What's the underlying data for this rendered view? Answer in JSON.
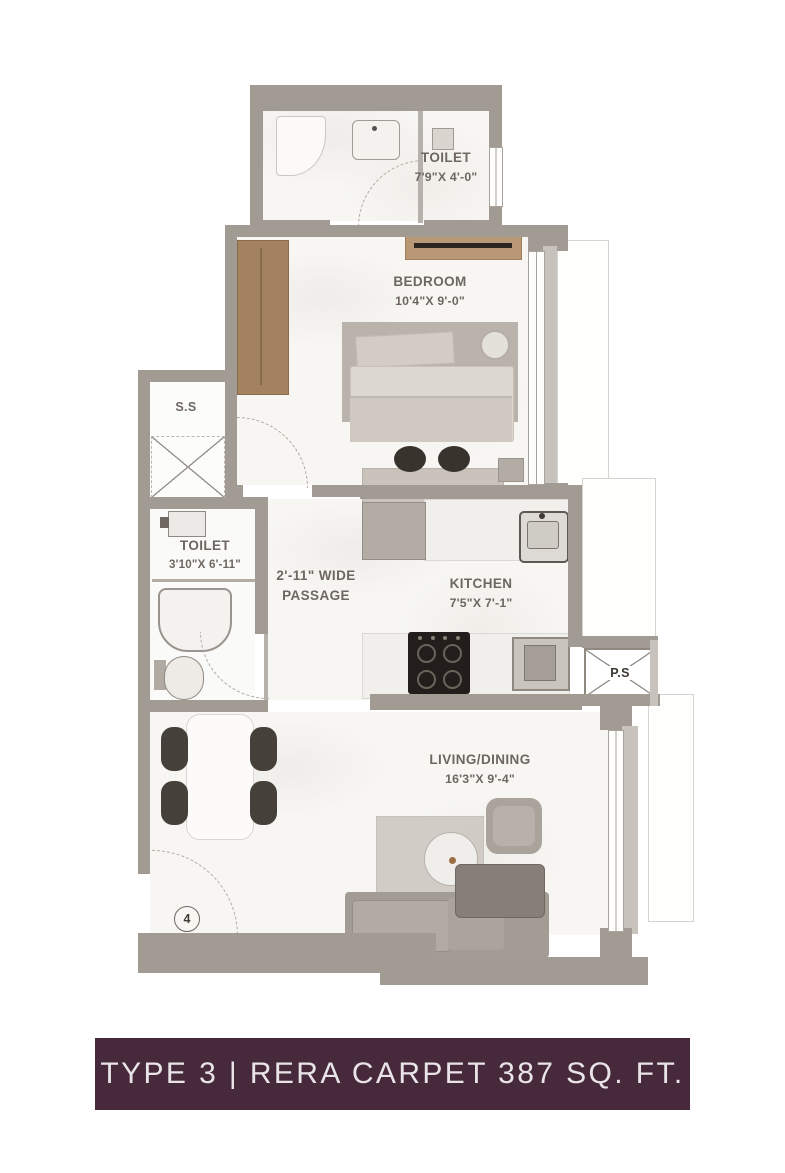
{
  "banner": {
    "text": "TYPE 3 | RERA CARPET 387 SQ. FT.",
    "bg_color": "#46293A",
    "text_color": "#E9E4E7"
  },
  "plan": {
    "entrance_number": "4",
    "wall_color": "#A19B94",
    "wood_color": "#A3835F",
    "rooms": [
      {
        "id": "toilet-top",
        "name": "TOILET",
        "dims": "7'9\"X 4'-0\""
      },
      {
        "id": "bedroom",
        "name": "BEDROOM",
        "dims": "10'4\"X 9'-0\""
      },
      {
        "id": "shaft-ss",
        "name": "S.S"
      },
      {
        "id": "toilet-left",
        "name": "TOILET",
        "dims": "3'10\"X 6'-11\""
      },
      {
        "id": "passage",
        "line1": "2'-11\" WIDE",
        "line2": "PASSAGE"
      },
      {
        "id": "kitchen",
        "name": "KITCHEN",
        "dims": "7'5\"X 7'-1\""
      },
      {
        "id": "shaft-ps",
        "name": "P.S"
      },
      {
        "id": "living-dining",
        "name": "LIVING/DINING",
        "dims": "16'3\"X 9'-4\""
      }
    ]
  }
}
